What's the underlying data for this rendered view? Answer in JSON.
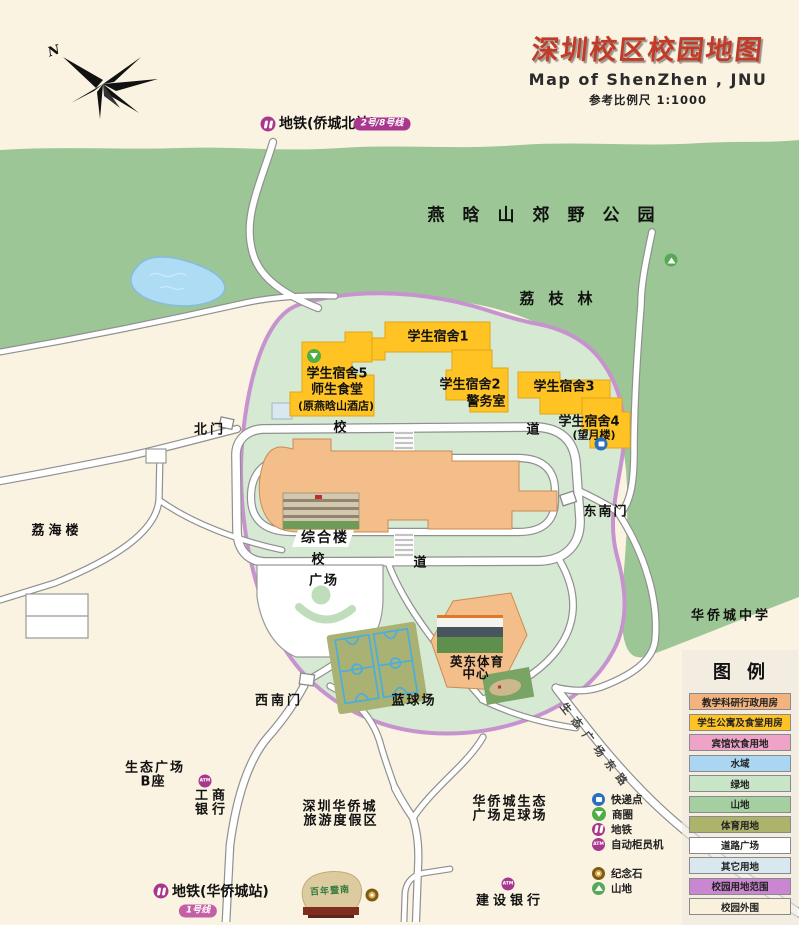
{
  "header": {
    "title_zh": "深圳校区校园地图",
    "title_en": "Map of ShenZhen , JNU",
    "scale_note": "参考比例尺  1:1000"
  },
  "compass": {
    "north_label": "N"
  },
  "colors": {
    "title_red": "#C23B28",
    "metro_purple": "#A8378E",
    "badge_pink": "#C45FA5",
    "park_green": "#9CC696",
    "campus_green": "#D6E9D2",
    "campus_boundary_purple": "#C793CF",
    "building_yellow": "#FFC424",
    "building_orange": "#F4BE8A",
    "water_blue": "#AEDCF5",
    "sports_olive": "#A9B173",
    "court_blue": "#45AEE5",
    "background_cream": "#FBF3E1"
  },
  "transit": {
    "north_station": {
      "label": "地铁(侨城北站)",
      "lines_badge": "2号/8号线"
    },
    "south_station": {
      "label": "地铁(华侨城站)",
      "lines_badge": "1号线"
    }
  },
  "park": {
    "name": "燕晗山郊野公园",
    "lychee_grove": "荔枝林"
  },
  "campus": {
    "gates": {
      "north": "北门",
      "southeast": "东南门",
      "southwest": "西南门"
    },
    "roads": {
      "char1": "校",
      "char2": "道"
    },
    "buildings": {
      "dorm1": "学生宿舍1",
      "dorm5": "学生宿舍5",
      "canteen": "师生食堂",
      "canteen_note": "(原燕晗山酒店)",
      "dorm2": "学生宿舍2",
      "police": "警务室",
      "dorm3": "学生宿舍3",
      "dorm4": "学生宿舍4",
      "dorm4_note": "(望月楼)",
      "complex": "综合楼",
      "sports_line1": "英东体育",
      "sports_line2": "中心",
      "plaza": "广场",
      "basketball": "蓝球场"
    }
  },
  "surroundings": {
    "lihai": "荔海楼",
    "oct_school": "华侨城中学",
    "eco_plaza_line1": "生态广场",
    "eco_plaza_line2": "B座",
    "icbc_line1": "工商",
    "icbc_line2": "银行",
    "resort_line1": "深圳华侨城",
    "resort_line2": "旅游度假区",
    "soccer_line1": "华侨城生态",
    "soccer_line2": "广场足球场",
    "ccb": "建设银行",
    "diag_road": "生态广场东路",
    "stone_text": "百年暨南"
  },
  "legend": {
    "title": "图例",
    "items": [
      {
        "label": "教学科研行政用房",
        "color": "#F2B37E"
      },
      {
        "label": "学生公寓及食堂用房",
        "color": "#FFC424"
      },
      {
        "label": "宾馆饮食用地",
        "color": "#F0A3C8"
      },
      {
        "label": "水域",
        "color": "#AAD6F2"
      },
      {
        "label": "绿地",
        "color": "#C9E5C8"
      },
      {
        "label": "山地",
        "color": "#A5CFA1"
      },
      {
        "label": "体育用地",
        "color": "#ADB36B"
      },
      {
        "label": "道路广场",
        "color": "#FFFFFF"
      },
      {
        "label": "其它用地",
        "color": "#D9E7EE"
      },
      {
        "label": "校园用地范围",
        "color": "#CB86D2"
      },
      {
        "label": "校园外围",
        "color": "#FAF1DC"
      }
    ]
  },
  "poi_legend": {
    "group1": [
      {
        "icon": "parcel-icon",
        "label": "快递点"
      },
      {
        "icon": "shop-icon",
        "label": "商圈"
      },
      {
        "icon": "metro-icon",
        "label": "地铁"
      },
      {
        "icon": "atm-icon",
        "label": "自动柜员机"
      }
    ],
    "group2": [
      {
        "icon": "stone-icon",
        "label": "纪念石"
      },
      {
        "icon": "mountain-icon",
        "label": "山地"
      }
    ]
  },
  "icons": {
    "atm_text": "ATM"
  }
}
